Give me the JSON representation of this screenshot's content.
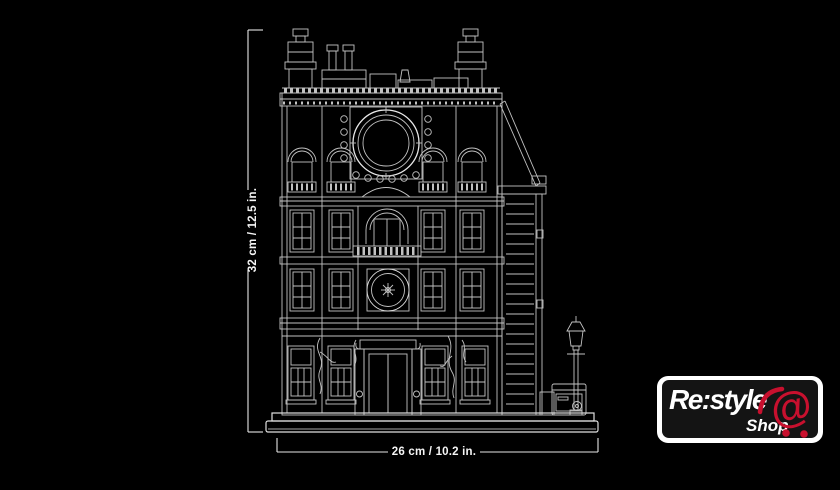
{
  "image": {
    "background": "#000000"
  },
  "dimensions": {
    "height_label": "32 cm / 12.5 in.",
    "width_label": "26 cm / 10.2 in.",
    "line_color": "#e6e6e6",
    "text_color": "#f5f5f5"
  },
  "blueprint": {
    "line_color": "#c2c2c2",
    "accent_line_color": "#ededed"
  },
  "logo": {
    "brand": "Re:style",
    "shop": "Shop",
    "at_symbol": "@",
    "accent_red": "#c8102e",
    "panel_black": "#141414",
    "frame_white": "#ffffff"
  }
}
